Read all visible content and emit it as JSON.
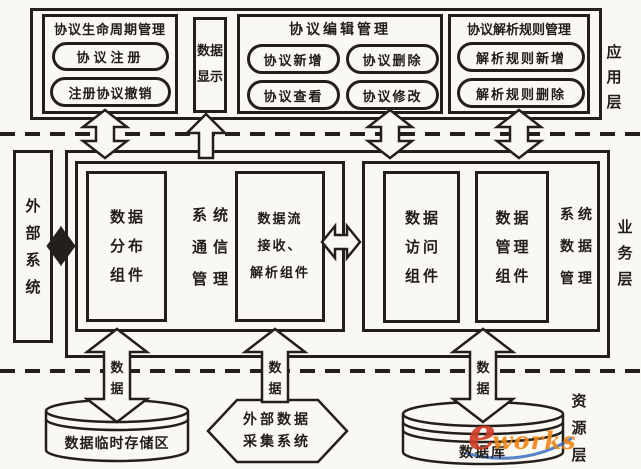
{
  "app_layer": {
    "label": "应\n用\n层",
    "lifecycle": {
      "title": "协议生命周期管理",
      "btn_register": "协议注册",
      "btn_revoke": "注册协议撤销"
    },
    "data_display": "数据\n显示",
    "edit": {
      "title": "协议编辑管理",
      "btn_add": "协议新增",
      "btn_delete": "协议删除",
      "btn_view": "协议查看",
      "btn_modify": "协议修改"
    },
    "rules": {
      "title": "协议解析规则管理",
      "btn_rule_add": "解析规则新增",
      "btn_rule_delete": "解析规则删除"
    }
  },
  "business_layer": {
    "label": "业\n务\n层",
    "external_system": "外\n部\n系\n统",
    "comm_group": {
      "label": "系统\n通信\n管理",
      "distribution": "数据\n分布\n组件",
      "stream": "数据流\n接收、\n解析组件"
    },
    "data_group": {
      "label": "系统\n数据\n管理",
      "access": "数据\n访问\n组件",
      "manage": "数据\n管理\n组件"
    }
  },
  "resource_layer": {
    "label": "资\n源\n层",
    "temp_storage": "数据临时存储区",
    "collector": "外部数据\n采集系统",
    "database": "数据库",
    "data_label": "数\n据"
  },
  "watermark": {
    "e": "e",
    "works": "works"
  }
}
